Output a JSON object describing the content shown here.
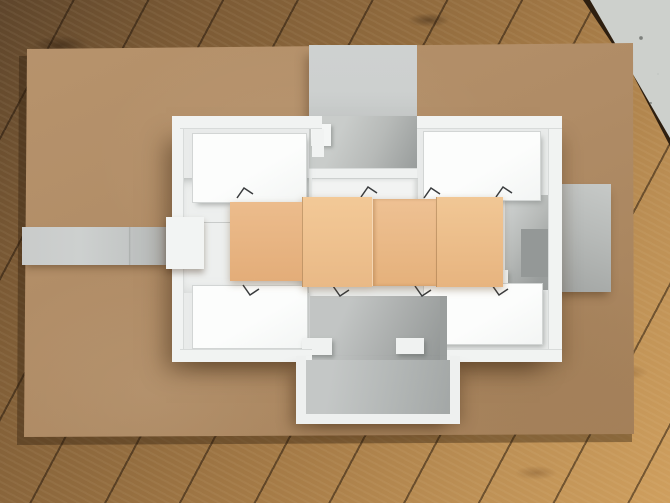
{
  "scene": {
    "type": "photograph",
    "subject": "white foam-board architecture model laid on a kraft paper sheet on a wooden plank floor",
    "view": "top-down"
  },
  "objects": {
    "floor": "wooden plank floor",
    "sheet": "kraft paper backing sheet",
    "model": "white foam-board building model with four roofed rooms and courtyards",
    "accordion": "peach accordion-folded paper strip across the model",
    "cards": [
      "grey card strip (left)",
      "grey card arm (top)",
      "grey card (right)",
      "grey card courtyard with white frame (bottom)",
      "concrete ledge (top-right corner)"
    ],
    "wire_clip_count": 8,
    "accordion_panel_count": 4
  },
  "colors": {
    "wood_dark": "#5e452b",
    "wood_mid": "#916b3e",
    "wood_light": "#cf9f5e",
    "wood_seam": "#2e1f10",
    "kraft": "#b08c66",
    "kraft_light": "#b8946d",
    "kraft_dark": "#a07b55",
    "card_light": "#cdd0cf",
    "card_mid": "#b7bab8",
    "card_dark": "#999d9c",
    "concrete": "#b7bab6",
    "model_white": "#e9ebea",
    "wall_white": "#f1f3f2",
    "roof_white": "#fcfdfc",
    "wall_line": "#d2d5d4",
    "shadow_cool": "#949897",
    "wire": "#3a3c3e",
    "accordion_panels": [
      {
        "top": "#ecbc8c",
        "bottom": "#e3ad79"
      },
      {
        "top": "#f3c997",
        "bottom": "#e9b986"
      },
      {
        "top": "#eec193",
        "bottom": "#e5b17b"
      },
      {
        "top": "#f1c795",
        "bottom": "#e7b47f"
      }
    ]
  }
}
